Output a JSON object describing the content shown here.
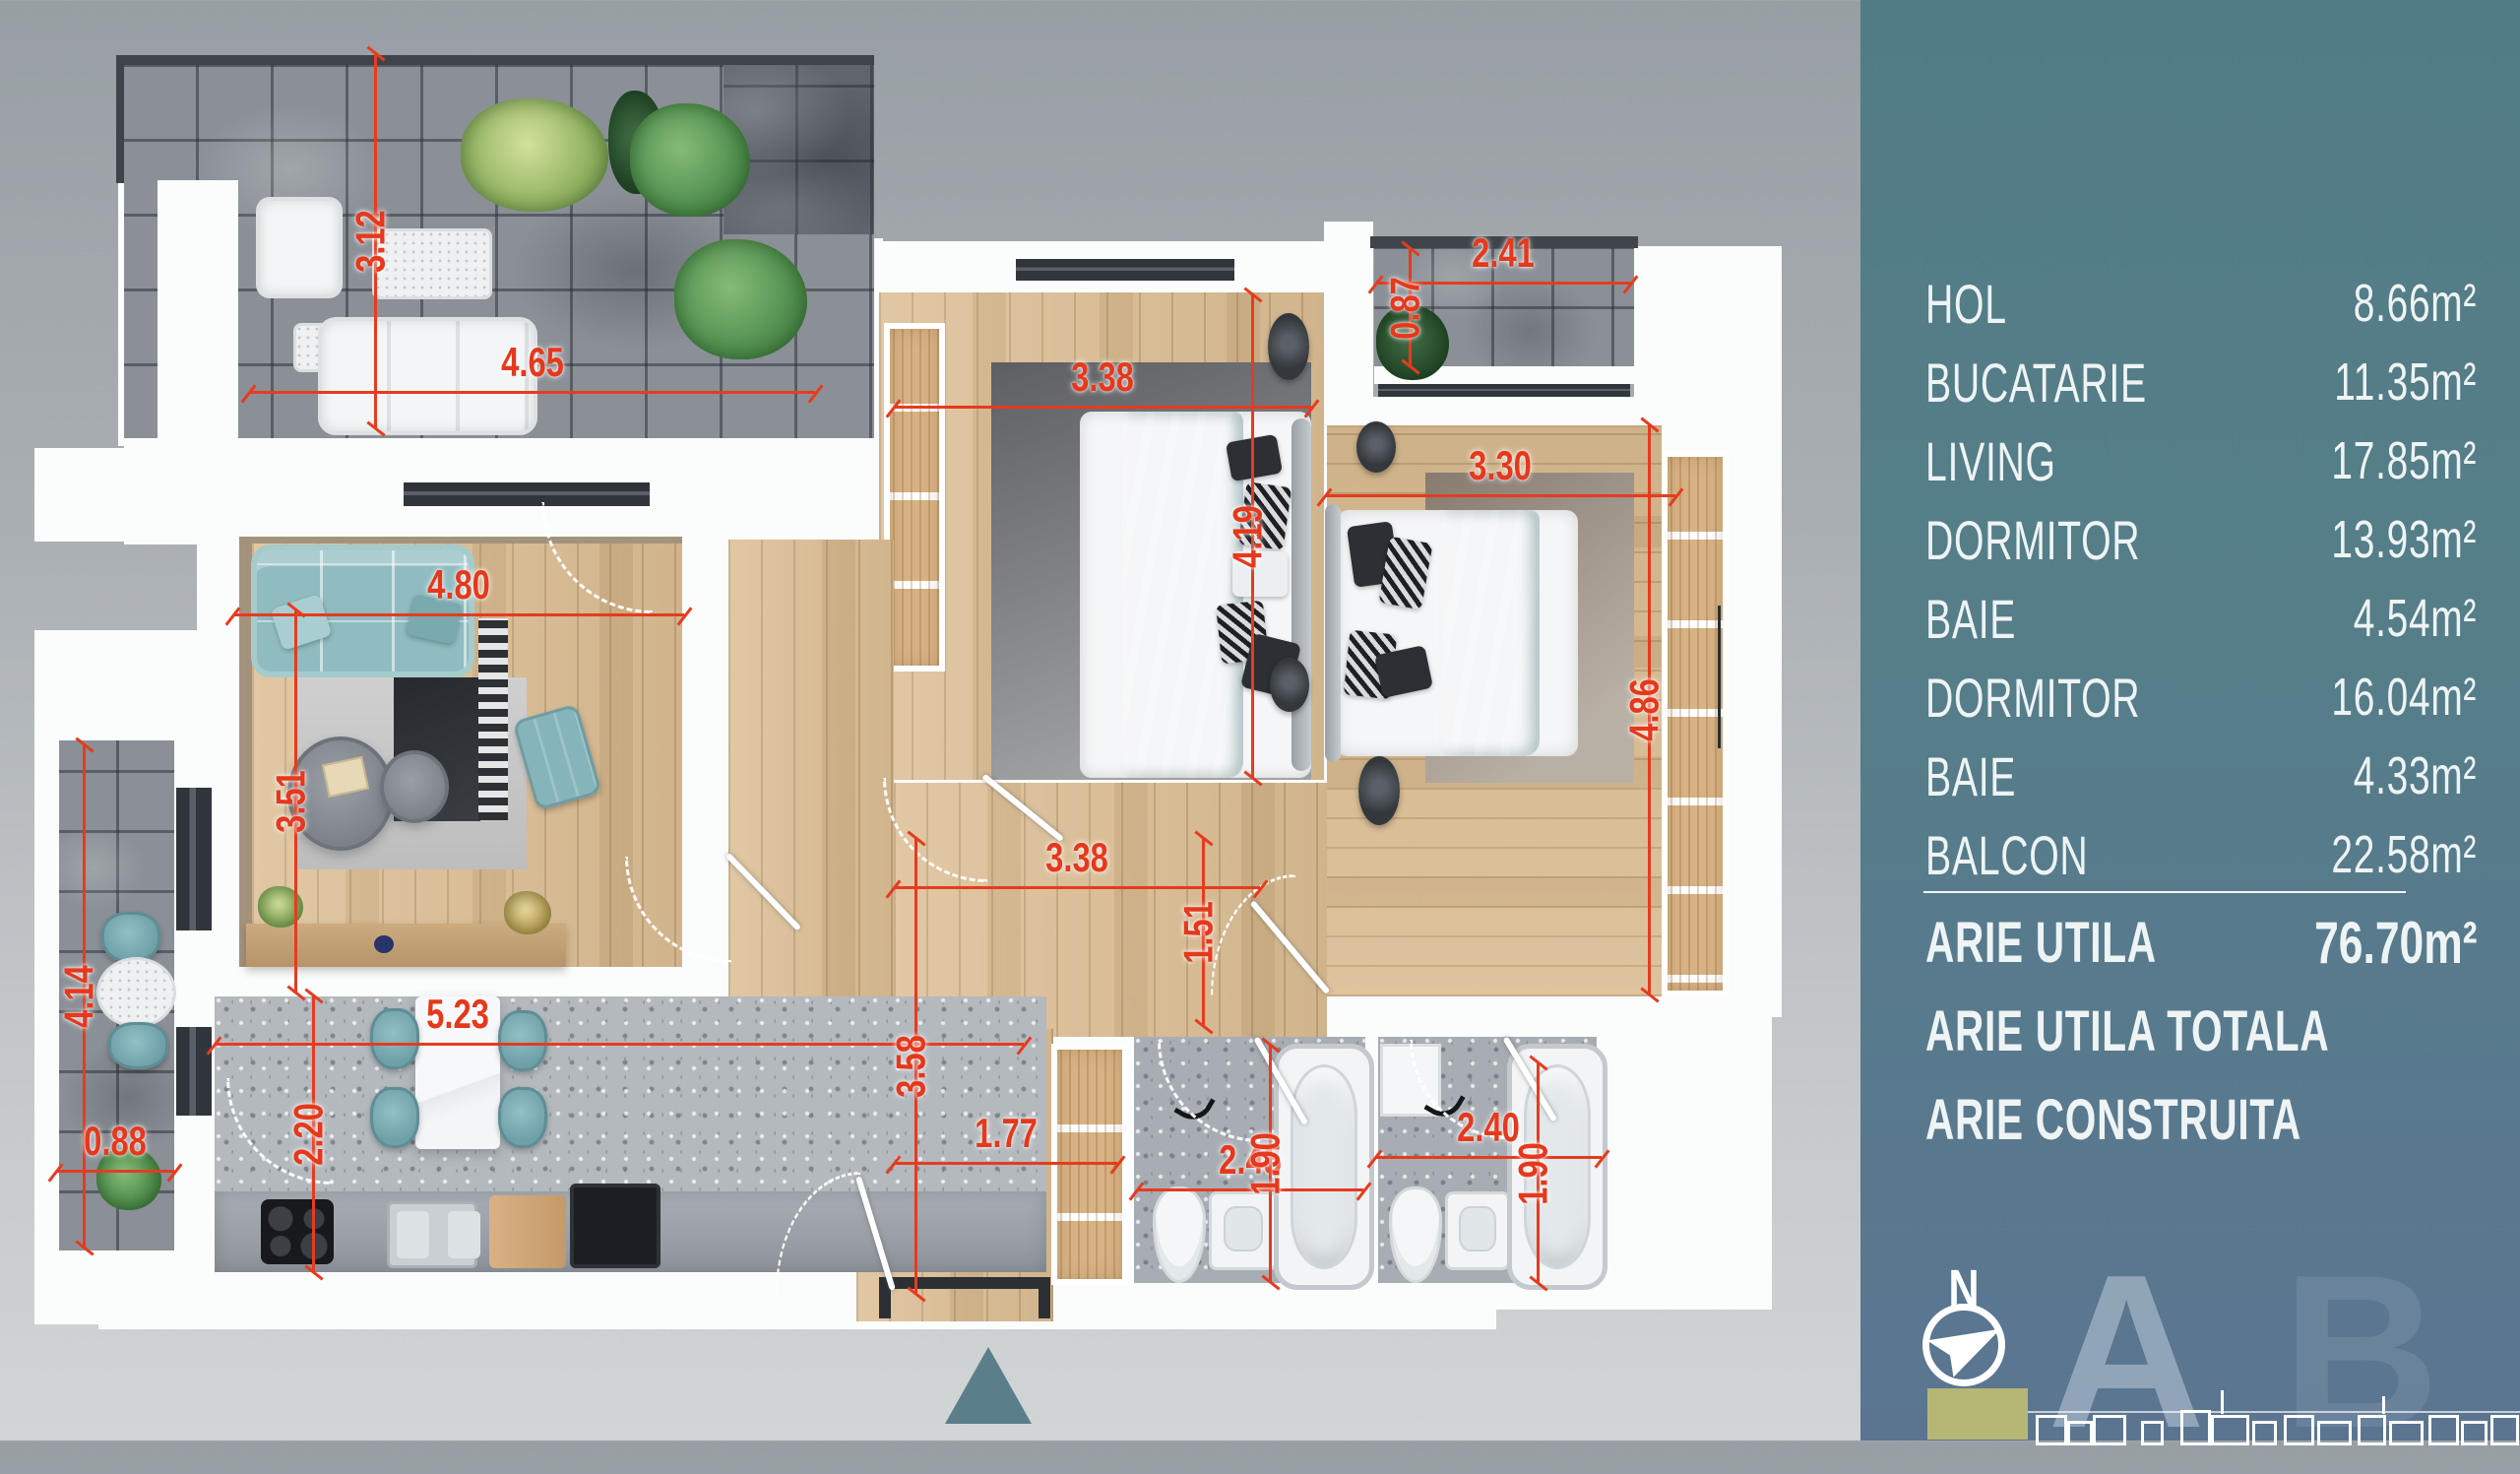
{
  "sidebar": {
    "rooms": [
      {
        "label": "HOL",
        "area": "8.66m²"
      },
      {
        "label": "BUCATARIE",
        "area": "11.35m²"
      },
      {
        "label": "LIVING",
        "area": "17.85m²"
      },
      {
        "label": "DORMITOR",
        "area": "13.93m²"
      },
      {
        "label": "BAIE",
        "area": "4.54m²"
      },
      {
        "label": "DORMITOR",
        "area": "16.04m²"
      },
      {
        "label": "BAIE",
        "area": "4.33m²"
      },
      {
        "label": "BALCON",
        "area": "22.58m²"
      }
    ],
    "totals": [
      {
        "label": "ARIE UTILA",
        "area": "76.70m²"
      },
      {
        "label": "ARIE UTILA TOTALA",
        "area": "99.25m²"
      },
      {
        "label": "ARIE CONSTRUITA",
        "area": "127.40m²"
      }
    ],
    "compass_label": "N",
    "section_a": "A",
    "section_b": "B"
  },
  "plan": {
    "dims": {
      "terrace_height": "3.12",
      "terrace_width": "4.65",
      "balcony_top_width": "2.41",
      "balcony_top_depth": "0.87",
      "bedroom1_width": "3.38",
      "bedroom1_height": "4.19",
      "living_width": "4.80",
      "living_height": "3.51",
      "bedroom2_width": "3.30",
      "bedroom2_height": "4.86",
      "balcony_left_height": "4.14",
      "balcony_left_width": "0.88",
      "kitchen_width": "5.23",
      "kitchen_depth": "2.20",
      "hall_width": "3.38",
      "hall_depth": "1.51",
      "hall_height": "3.58",
      "hall_entry_width": "1.77",
      "bath1_width": "2.45",
      "bath1_depth": "1.90",
      "bath2_width": "2.40",
      "bath2_depth": "1.90"
    }
  },
  "colors": {
    "accent_red": "#e6381c",
    "sidebar_top": "#527c85",
    "sidebar_bottom": "#5b7591",
    "highlight_olive": "#b6b675",
    "wood": "#dcbe94",
    "teal_furniture": "#8ebcc0"
  }
}
